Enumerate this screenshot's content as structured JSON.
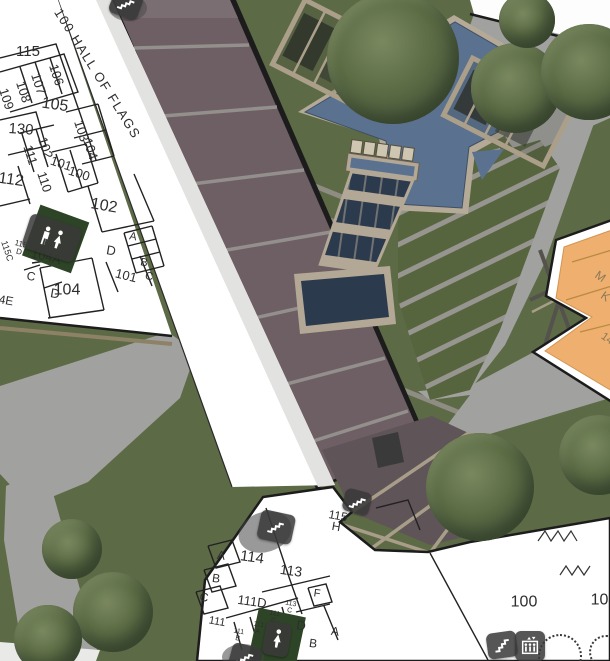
{
  "app": {
    "type": "3d-campus-map",
    "floor_shown": "level-1"
  },
  "colors": {
    "grass": "#5d6a46",
    "grass_dark": "#51603c",
    "path": "#a1a19f",
    "terrace": "#6e5f64",
    "water": "#5a7190",
    "water_dark": "#2c3a4d",
    "pergola": "#ab9f8a",
    "building_fill": "#ffffff",
    "wall": "#1c1c1c",
    "highlight_building": "#efaf6f",
    "restroom_room": "#2e4426",
    "icon_plate": "#383838",
    "map_background": "#ececea"
  },
  "map": {
    "labels": [
      {
        "t": "115",
        "x": 28,
        "y": 52,
        "r": 0,
        "s": 15
      },
      {
        "t": "106",
        "x": 56,
        "y": 75,
        "r": 72,
        "s": 13
      },
      {
        "t": "107",
        "x": 38,
        "y": 84,
        "r": 72,
        "s": 13
      },
      {
        "t": "108",
        "x": 23,
        "y": 92,
        "r": 72,
        "s": 13
      },
      {
        "t": "109",
        "x": 6,
        "y": 99,
        "r": 72,
        "s": 13
      },
      {
        "t": "105",
        "x": 55,
        "y": 105,
        "r": 8,
        "s": 16
      },
      {
        "t": "130",
        "x": 21,
        "y": 130,
        "r": 4,
        "s": 15
      },
      {
        "t": "103",
        "x": 81,
        "y": 131,
        "r": 72,
        "s": 13
      },
      {
        "t": "104",
        "x": 90,
        "y": 149,
        "r": 72,
        "s": 13
      },
      {
        "t": "102",
        "x": 45,
        "y": 148,
        "r": 72,
        "s": 13
      },
      {
        "t": "111",
        "x": 30,
        "y": 155,
        "r": 72,
        "s": 13
      },
      {
        "t": "101",
        "x": 61,
        "y": 164,
        "r": 18,
        "s": 13
      },
      {
        "t": "112",
        "x": 11,
        "y": 180,
        "r": 8,
        "s": 16
      },
      {
        "t": "110",
        "x": 44,
        "y": 182,
        "r": 72,
        "s": 13
      },
      {
        "t": "100",
        "x": 79,
        "y": 174,
        "r": 18,
        "s": 13
      },
      {
        "t": "102",
        "x": 104,
        "y": 206,
        "r": 10,
        "s": 16
      },
      {
        "t": "A",
        "x": 133,
        "y": 237,
        "r": 10,
        "s": 11
      },
      {
        "t": "D",
        "x": 111,
        "y": 251,
        "r": 10,
        "s": 13
      },
      {
        "t": "B",
        "x": 144,
        "y": 263,
        "r": 10,
        "s": 11
      },
      {
        "t": "101",
        "x": 126,
        "y": 276,
        "r": 14,
        "s": 13
      },
      {
        "t": "C",
        "x": 149,
        "y": 277,
        "r": 10,
        "s": 11
      },
      {
        "t": "115C",
        "x": 7,
        "y": 251,
        "r": 72,
        "s": 9
      },
      {
        "t": "115",
        "t2": "D",
        "x": 20,
        "y": 248,
        "r": 14,
        "s": 8
      },
      {
        "t": "104A",
        "x": 46,
        "y": 257,
        "r": 14,
        "s": 13
      },
      {
        "t": "104",
        "x": 67,
        "y": 290,
        "r": 0,
        "s": 16
      },
      {
        "t": "C",
        "x": 31,
        "y": 277,
        "r": 10,
        "s": 12
      },
      {
        "t": "D",
        "x": 55,
        "y": 294,
        "r": 10,
        "s": 13
      },
      {
        "t": "4E",
        "x": 6,
        "y": 301,
        "r": 10,
        "s": 12
      },
      {
        "t": "100 HALL OF FLAGS",
        "x": 97,
        "y": 74,
        "r": 58,
        "s": 13,
        "ls": 1.5
      },
      {
        "t": "115",
        "t2": "H",
        "x": 337,
        "y": 522,
        "r": 10,
        "s": 12
      },
      {
        "t": "114",
        "x": 252,
        "y": 558,
        "r": 8,
        "s": 15
      },
      {
        "t": "A",
        "x": 221,
        "y": 556,
        "r": 8,
        "s": 12
      },
      {
        "t": "B",
        "x": 216,
        "y": 579,
        "r": 8,
        "s": 12
      },
      {
        "t": "C",
        "x": 204,
        "y": 598,
        "r": 8,
        "s": 12
      },
      {
        "t": "113",
        "x": 291,
        "y": 571,
        "r": 8,
        "s": 14
      },
      {
        "t": "111D",
        "x": 252,
        "y": 602,
        "r": 8,
        "s": 13
      },
      {
        "t": "F",
        "x": 317,
        "y": 594,
        "r": 8,
        "s": 11
      },
      {
        "t": "111",
        "x": 217,
        "y": 622,
        "r": 10,
        "s": 11
      },
      {
        "t": "111",
        "t2": "B",
        "x": 238,
        "y": 636,
        "r": 10,
        "s": 7
      },
      {
        "t": "111",
        "t2": "A",
        "x": 258,
        "y": 629,
        "r": 10,
        "s": 7
      },
      {
        "t": "111",
        "t2": "C",
        "x": 274,
        "y": 618,
        "r": 10,
        "s": 7
      },
      {
        "t": "113",
        "t2": "C",
        "x": 290,
        "y": 608,
        "r": 10,
        "s": 7
      },
      {
        "t": "D",
        "x": 301,
        "y": 626,
        "r": 8,
        "s": 13
      },
      {
        "t": "A",
        "x": 335,
        "y": 632,
        "r": 8,
        "s": 12
      },
      {
        "t": "B",
        "x": 313,
        "y": 644,
        "r": 8,
        "s": 12
      },
      {
        "t": "100",
        "x": 524,
        "y": 602,
        "r": 0,
        "s": 16
      },
      {
        "t": "101",
        "x": 604,
        "y": 600,
        "r": 0,
        "s": 16
      },
      {
        "t": "M",
        "x": 600,
        "y": 277,
        "r": 35,
        "s": 12,
        "c": "#8a7a58"
      },
      {
        "t": "K",
        "x": 605,
        "y": 297,
        "r": 35,
        "s": 12,
        "c": "#8a7a58"
      },
      {
        "t": "14",
        "x": 607,
        "y": 339,
        "r": 35,
        "s": 11,
        "c": "#8a7a58"
      }
    ],
    "icons": [
      {
        "type": "stairs",
        "x": 126,
        "y": 4,
        "r": 20
      },
      {
        "type": "restroom-mw",
        "x": 52,
        "y": 238,
        "r": 18
      },
      {
        "type": "stairs",
        "x": 276,
        "y": 527,
        "r": 12,
        "sc": 1.15
      },
      {
        "type": "stairs",
        "x": 357,
        "y": 502,
        "r": 15,
        "sc": 0.9
      },
      {
        "type": "stairs",
        "x": 245,
        "y": 658,
        "r": 15
      },
      {
        "type": "restroom-w",
        "x": 277,
        "y": 639,
        "r": 10
      },
      {
        "type": "stairs",
        "x": 502,
        "y": 645,
        "r": -8
      },
      {
        "type": "elevator",
        "x": 530,
        "y": 646,
        "r": 0
      }
    ],
    "trees": [
      {
        "x": 393,
        "y": 58,
        "rad": 66
      },
      {
        "x": 516,
        "y": 88,
        "rad": 45
      },
      {
        "x": 589,
        "y": 72,
        "rad": 48
      },
      {
        "x": 527,
        "y": 20,
        "rad": 28
      },
      {
        "x": 480,
        "y": 487,
        "rad": 54
      },
      {
        "x": 599,
        "y": 455,
        "rad": 40
      },
      {
        "x": 72,
        "y": 549,
        "rad": 30
      },
      {
        "x": 113,
        "y": 612,
        "rad": 40
      },
      {
        "x": 48,
        "y": 639,
        "rad": 34
      }
    ],
    "plan_trees": [
      {
        "x": 558,
        "y": 654,
        "rad": 20
      },
      {
        "x": 604,
        "y": 650,
        "rad": 15
      }
    ]
  }
}
